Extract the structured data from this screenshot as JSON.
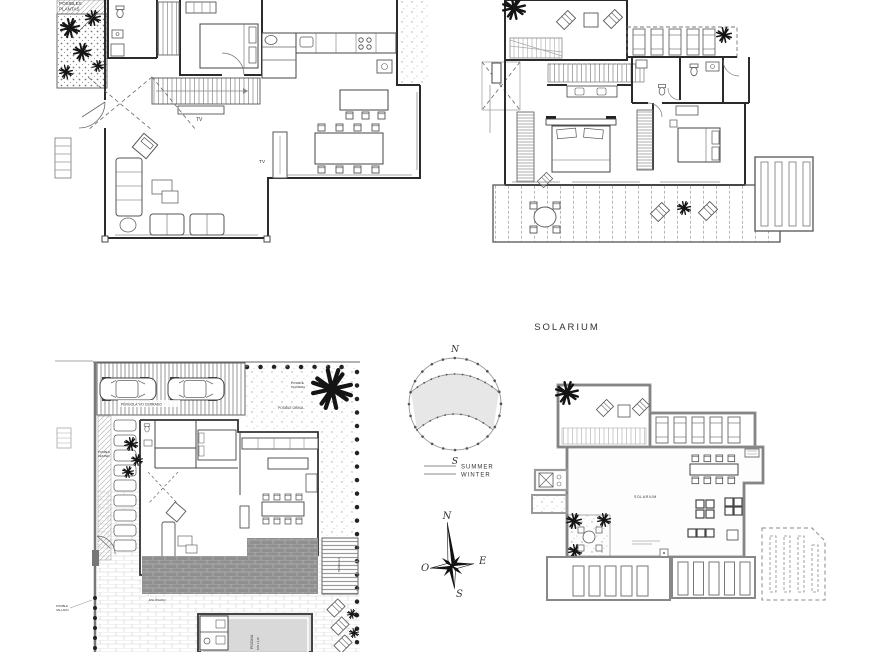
{
  "colors": {
    "background": "#ffffff",
    "wall_dark": "#2b2b2b",
    "wall_gray": "#8d8d8d",
    "text_gray": "#777777",
    "deck_gray": "#8f8f8f",
    "pool_water": "#d9d9d9",
    "sun_shade": "#e3e3e3"
  },
  "headings": {
    "solarium": "SOLARIUM"
  },
  "sun_diagram": {
    "north": "N",
    "south": "S",
    "summer": "SUMMER",
    "winter": "WINTER"
  },
  "compass": {
    "north": "N",
    "south": "S",
    "east": "E",
    "west": "O"
  },
  "plan_ground_floor": {
    "garden_label_line1": "POSIBLES",
    "garden_label_line2": "PLANTAS",
    "tv_label_stairs": "TV",
    "tv_label_living": "TV"
  },
  "plan_site": {
    "parking_label": "PÉRGOLA Y/O CERRADO",
    "palm_label_line1": "POSIBLE",
    "palm_label_line2": "PALMERA",
    "gravel_label": "POSIBLE GRAVA",
    "lawn_label_line1": "POSIBLE",
    "lawn_label_line2": "CESPED",
    "paving_label": "ENLOSADO",
    "pool_label": "PISCINA",
    "pool_dimensions": "8,50 x 4,40",
    "pergola_label": "PÉRGOLA",
    "fence_label_line1": "POSIBLE",
    "fence_label_line2": "VALLADO"
  },
  "plan_solarium": {
    "room_label": "SOLARIUM"
  }
}
